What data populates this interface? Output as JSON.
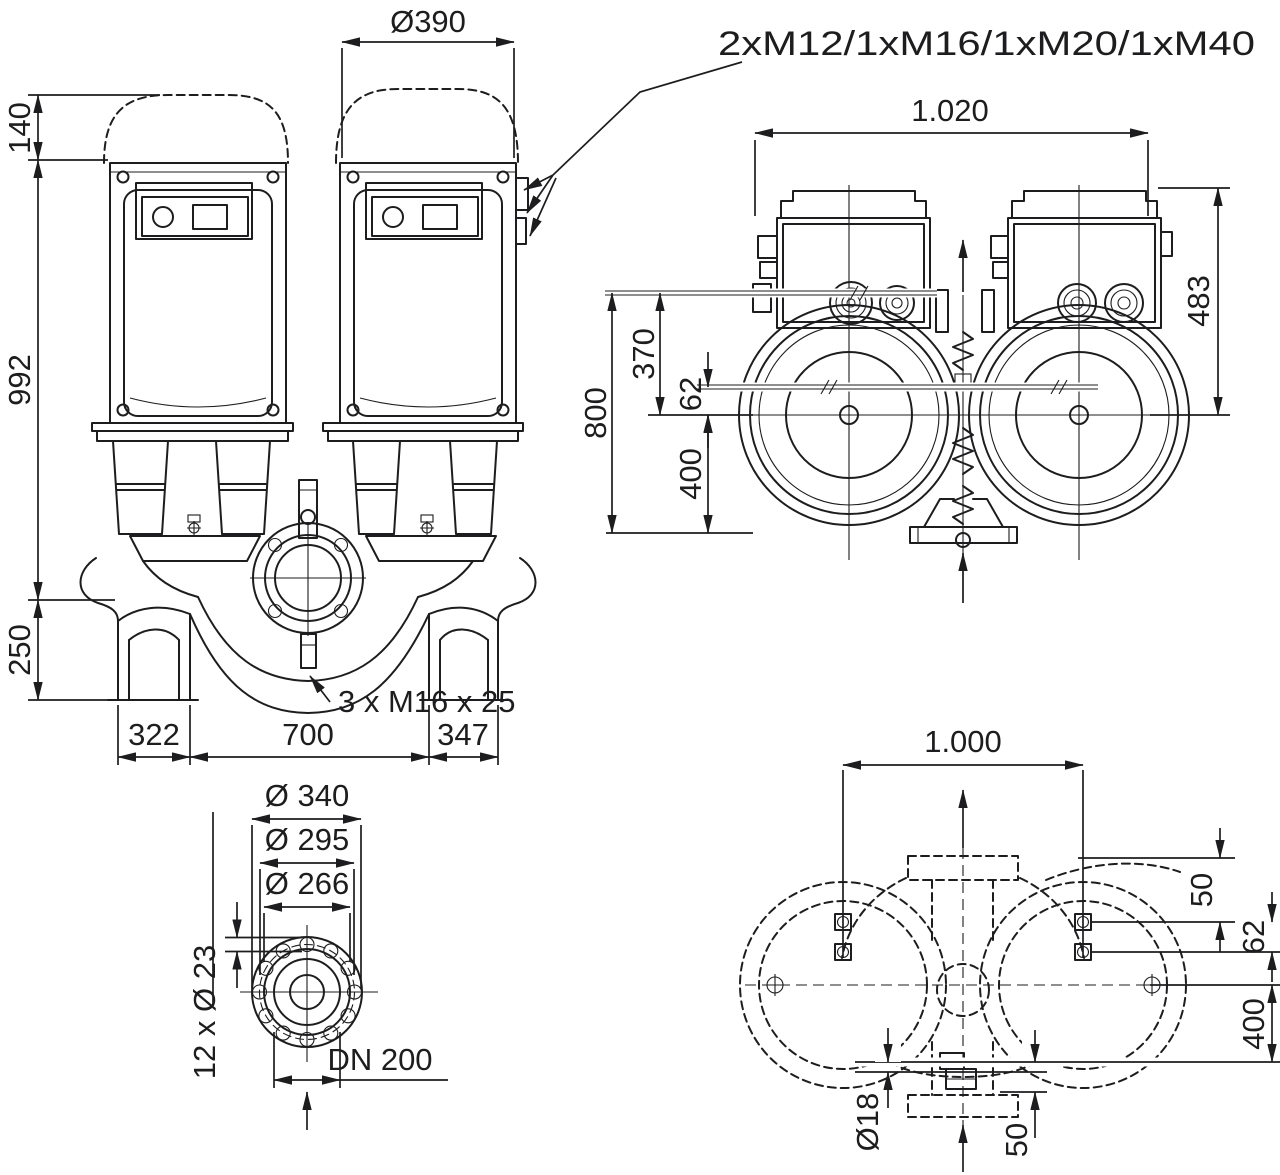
{
  "drawing": {
    "type": "pump dimensional drawing",
    "ink_color": "#1d1d1f",
    "background_color": "#ffffff",
    "front_view": {
      "dim_hood_diameter": "Ø390",
      "dim_hood_height": "140",
      "dim_body_height": "992",
      "dim_base_height": "250",
      "dim_bottom_left": "322",
      "dim_bottom_center": "700",
      "dim_bottom_right": "347",
      "label_cable_glands": "2xM12/1xM16/1xM20/1xM40",
      "label_tapped_holes": "3 x M16 x 25"
    },
    "top_view": {
      "dim_width": "1.020",
      "dim_depth_right": "483",
      "dim_depth_total": "800",
      "dim_rear_to_axis": "370",
      "dim_axis_offset": "62",
      "dim_axis_to_front": "400"
    },
    "flange_view": {
      "dim_outer_diameter": "Ø 340",
      "dim_bolt_circle": "Ø 295",
      "dim_raised_face": "Ø 266",
      "label_bolt_holes": "12 x Ø 23",
      "label_nominal_bore": "DN 200"
    },
    "foundation_view": {
      "dim_width": "1.000",
      "dim_edge_to_bolt": "50",
      "dim_bolt_spacing": "62",
      "dim_axis_to_edge": "400",
      "label_anchor_hole": "Ø18",
      "dim_flange_offset": "50"
    }
  }
}
